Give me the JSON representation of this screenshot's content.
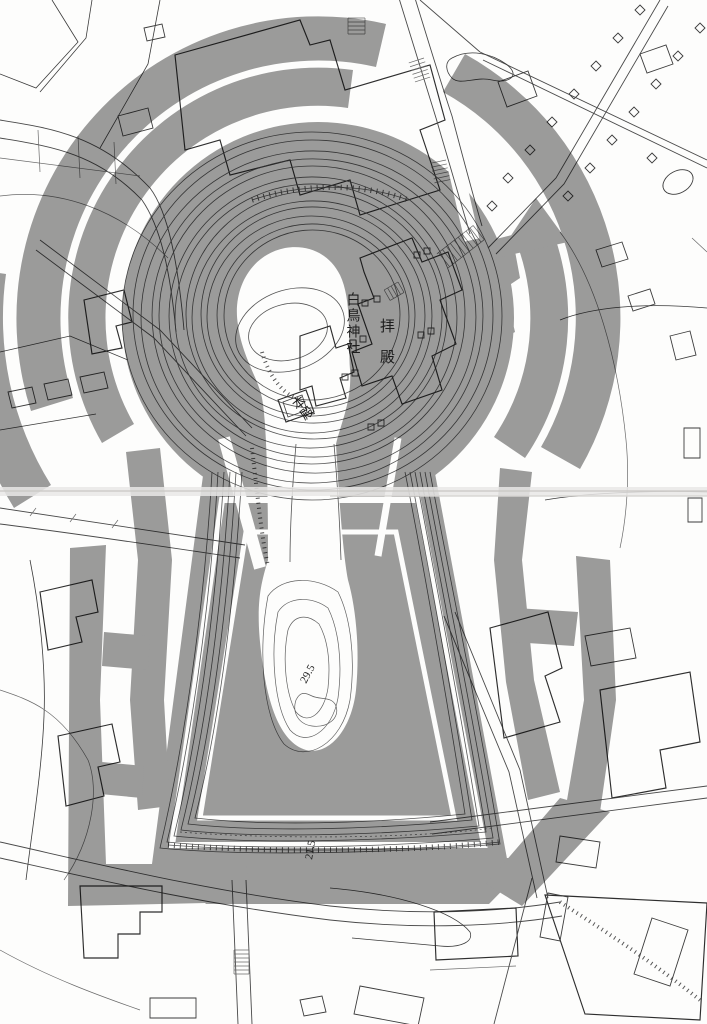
{
  "map": {
    "labels": {
      "shrine_name": "白鳥神社",
      "haiden": "拝殿",
      "honden": "本殿",
      "summit_elevation": "29.5",
      "front_elevation": "21.5"
    },
    "colors": {
      "overlay_gray": "#9c9c9c",
      "paper": "#fdfdfc",
      "line_dark": "#2e2e2e",
      "contour": "#555555",
      "fold": "#e9e8e6"
    }
  }
}
